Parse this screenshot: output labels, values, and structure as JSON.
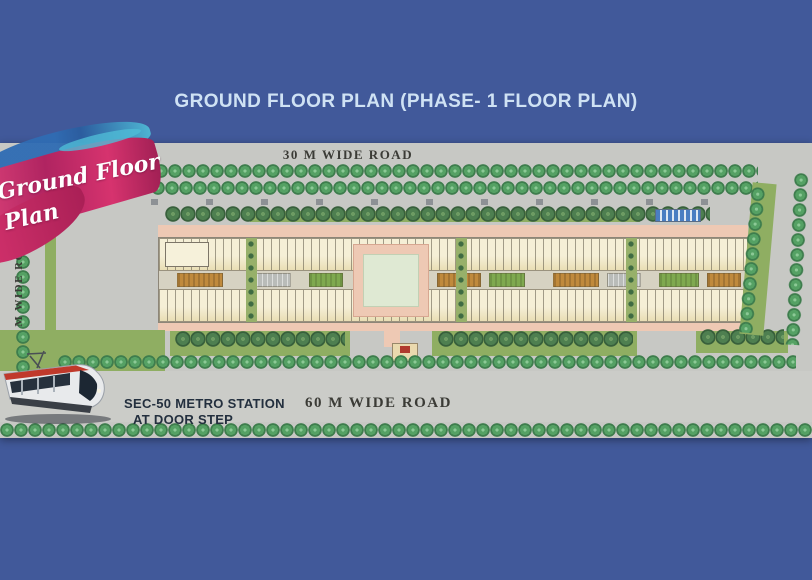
{
  "title": "GROUND FLOOR PLAN (PHASE- 1 FLOOR PLAN)",
  "roads": {
    "top": "30 M WIDE ROAD",
    "bottom": "60 M WIDE ROAD",
    "left": "M WIDE ROAD"
  },
  "overlay": {
    "line1": "Ground Floor",
    "line2": "Plan"
  },
  "metro": {
    "line1": "SEC-50 METRO STATION",
    "line2": "AT DOOR STEP"
  },
  "icons": {
    "metro_train": "metro-train-side-view"
  },
  "colors": {
    "background": "#41599A",
    "title_text": "#CFE2F4",
    "road_gray": "#C7C8C4",
    "road_light": "#CBCCC8",
    "tree": "#55A164",
    "tree_dark": "#4E7F50",
    "lawn": "#8FAE62",
    "shop_cream": "#F0E8C6",
    "pavement_pink": "#EEC9B4",
    "plaza_mint": "#DFE9D3",
    "courtyard_orange": "#C08A3C",
    "brush_pink": "#D6336E",
    "brush_magenta": "#B02461",
    "brush_blue": "#2F6CB3",
    "brush_cyan": "#4FBBD6",
    "caption_dark": "#232F3E",
    "gate_red": "#B03A2E"
  }
}
